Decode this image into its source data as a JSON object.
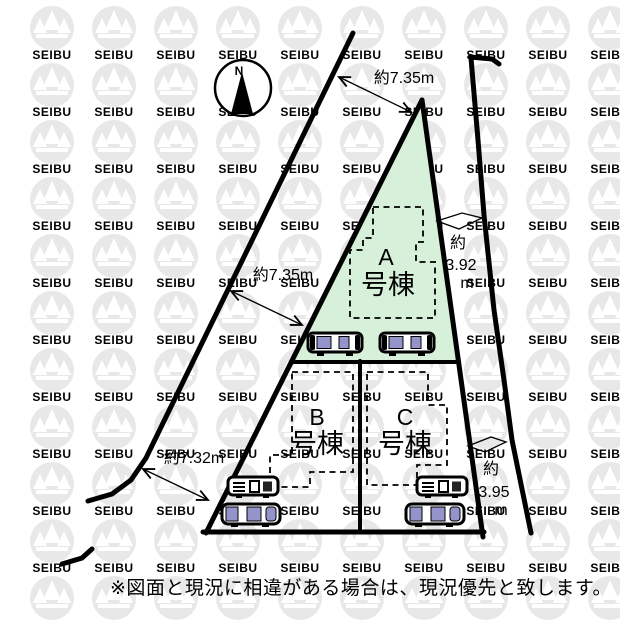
{
  "compass": {
    "label": "N"
  },
  "watermark": {
    "text": "SEIBU"
  },
  "buildings": {
    "a": {
      "letter": "A",
      "suffix": "号棟"
    },
    "b": {
      "letter": "B",
      "suffix": "号棟"
    },
    "c": {
      "letter": "C",
      "suffix": "号棟"
    }
  },
  "dimensions": {
    "top": "約7.35m",
    "left": "約7.35m",
    "bottom_left": "約7.32m",
    "right_upper": {
      "prefix": "約",
      "value": "3.92",
      "unit": "m"
    },
    "right_lower": {
      "prefix": "約",
      "value": "3.95",
      "unit": "m"
    }
  },
  "footnote": "※図面と現況に相違がある場合は、現況優先と致します。",
  "colors": {
    "lot_green": "#d7f0d9",
    "watermark_gray": "#e8e8e8",
    "car_purple": "#9494cb",
    "line_black": "#000000",
    "footnote_gray": "#333333"
  }
}
